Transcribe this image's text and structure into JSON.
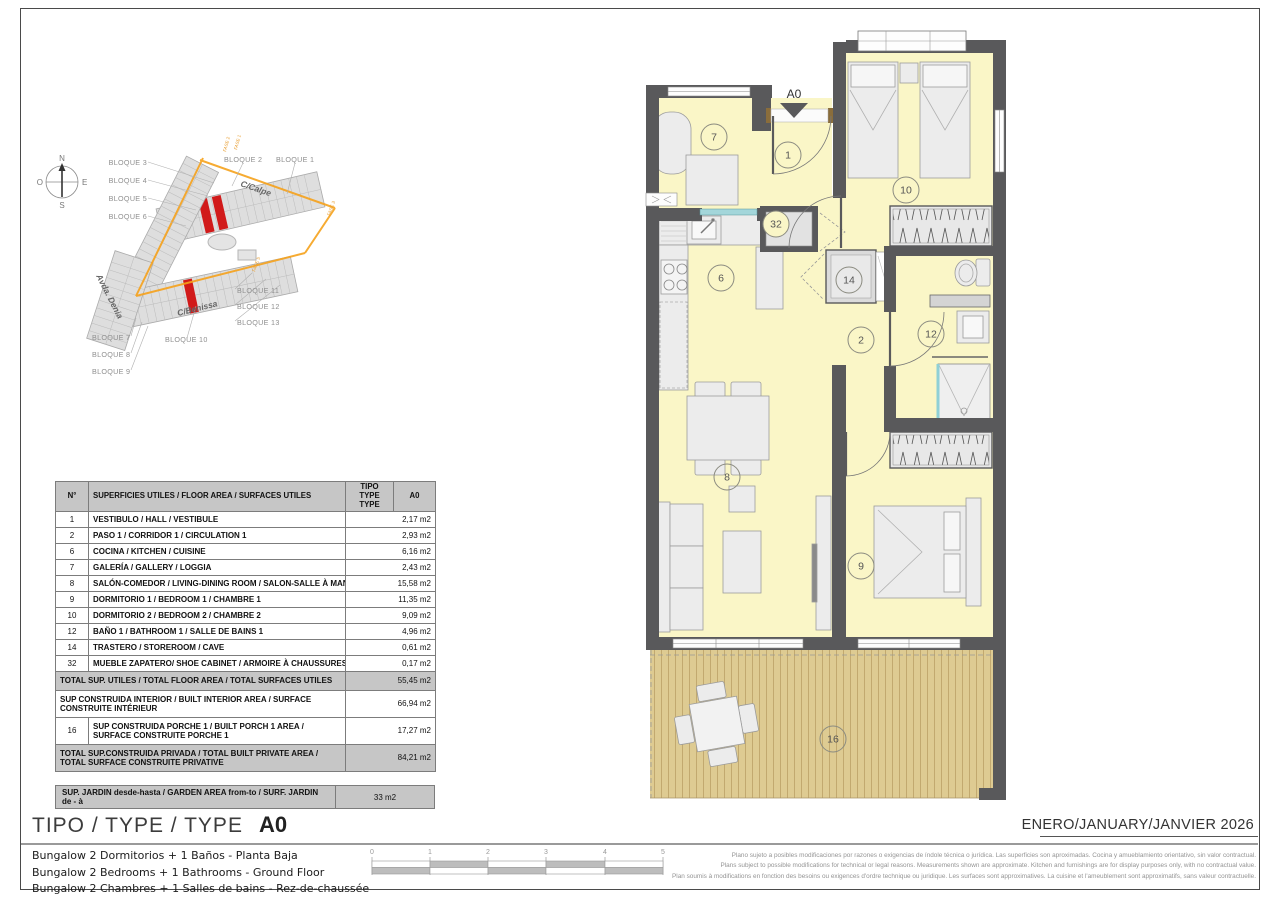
{
  "site_plan": {
    "compass": {
      "n": "N",
      "e": "E",
      "s": "S",
      "o": "O"
    },
    "labels": [
      {
        "text": "BLOQUE 3"
      },
      {
        "text": "BLOQUE 4"
      },
      {
        "text": "BLOQUE 5"
      },
      {
        "text": "BLOQUE 6"
      },
      {
        "text": "BLOQUE 2"
      },
      {
        "text": "BLOQUE 1"
      },
      {
        "text": "BLOQUE 11"
      },
      {
        "text": "BLOQUE 12"
      },
      {
        "text": "BLOQUE 13"
      },
      {
        "text": "BLOQUE 10"
      },
      {
        "text": "BLOQUE 7"
      },
      {
        "text": "BLOQUE 8"
      },
      {
        "text": "BLOQUE 9"
      }
    ],
    "streets": [
      {
        "text": "C/Calpe"
      },
      {
        "text": "C/Benissa"
      },
      {
        "text": "Avda. Denia"
      }
    ],
    "fase_labels": [
      {
        "text": "FASE 1"
      },
      {
        "text": "FASE 2"
      },
      {
        "text": "FASE 3"
      },
      {
        "text": "FASE 5"
      }
    ],
    "highlight_color": "#d11a1a",
    "road_color": "#f6a21c"
  },
  "area_table": {
    "header": {
      "num": "N°",
      "label": "SUPERFICIES UTILES / FLOOR AREA / SURFACES UTILES",
      "tipo": "TIPO TYPE TYPE",
      "a0": "A0"
    },
    "rows": [
      {
        "num": "1",
        "label": "VESTIBULO / HALL / VESTIBULE",
        "value": "2,17 m2"
      },
      {
        "num": "2",
        "label": "PASO 1 / CORRIDOR 1 / CIRCULATION 1",
        "value": "2,93 m2"
      },
      {
        "num": "6",
        "label": "COCINA / KITCHEN / CUISINE",
        "value": "6,16 m2"
      },
      {
        "num": "7",
        "label": "GALERÍA / GALLERY / LOGGIA",
        "value": "2,43 m2"
      },
      {
        "num": "8",
        "label": "SALÓN-COMEDOR / LIVING-DINING ROOM / SALON-SALLE À MANGER",
        "value": "15,58 m2"
      },
      {
        "num": "9",
        "label": "DORMITORIO 1 / BEDROOM 1 / CHAMBRE 1",
        "value": "11,35 m2"
      },
      {
        "num": "10",
        "label": "DORMITORIO 2 / BEDROOM 2 / CHAMBRE 2",
        "value": "9,09 m2"
      },
      {
        "num": "12",
        "label": "BAÑO 1 / BATHROOM 1 / SALLE DE BAINS 1",
        "value": "4,96 m2"
      },
      {
        "num": "14",
        "label": "TRASTERO / STOREROOM / CAVE",
        "value": "0,61 m2"
      },
      {
        "num": "32",
        "label": "MUEBLE ZAPATERO/ SHOE CABINET / ARMOIRE À CHAUSSURES",
        "value": "0,17 m2"
      }
    ],
    "total_utiles": {
      "label": "TOTAL SUP. UTILES / TOTAL FLOOR AREA / TOTAL SURFACES UTILES",
      "value": "55,45 m2"
    },
    "built_interior": {
      "label": "SUP CONSTRUIDA INTERIOR / BUILT INTERIOR AREA / SURFACE CONSTRUITE INTÉRIEUR",
      "value": "66,94 m2"
    },
    "porch": {
      "num": "16",
      "label": "SUP CONSTRUIDA PORCHE 1 / BUILT PORCH 1 AREA / SURFACE CONSTRUITE PORCHE 1",
      "value": "17,27 m2"
    },
    "total_private": {
      "label": "TOTAL SUP.CONSTRUIDA PRIVADA / TOTAL BUILT PRIVATE AREA / TOTAL SURFACE CONSTRUITE PRIVATIVE",
      "value": "84,21 m2"
    },
    "garden": {
      "label": "SUP. JARDIN desde-hasta / GARDEN AREA from-to / SURF. JARDIN de - à",
      "value": "33 m2"
    }
  },
  "floor_plan": {
    "entry_label": "A0",
    "room_fill": "#faf6c7",
    "wall_color": "#59595b",
    "terrace_fill": "#decb92",
    "rooms": [
      {
        "id": "7"
      },
      {
        "id": "1"
      },
      {
        "id": "10"
      },
      {
        "id": "32"
      },
      {
        "id": "6"
      },
      {
        "id": "14"
      },
      {
        "id": "2"
      },
      {
        "id": "12"
      },
      {
        "id": "8"
      },
      {
        "id": "9"
      },
      {
        "id": "16"
      }
    ]
  },
  "title_block": {
    "title_label": "TIPO / TYPE / TYPE",
    "title_value": "A0",
    "date": "ENERO/JANUARY/JANVIER 2026",
    "descriptions": [
      "Bungalow 2 Dormitorios + 1 Baños - Planta Baja",
      "Bungalow 2 Bedrooms + 1 Bathrooms - Ground Floor",
      "Bungalow 2 Chambres + 1 Salles de bains - Rez-de-chaussée"
    ],
    "scale_ticks": [
      "0",
      "1",
      "2",
      "3",
      "4",
      "5"
    ],
    "disclaimer": [
      "Plano sujeto a posibles modificaciones por razones o exigencias de índole técnica o jurídica. Las superficies son aproximadas. Cocina y amueblamiento orientativo, sin valor contractual.",
      "Plans subject to possible modifications for technical or legal reasons. Measurements shown are approximate. Kitchen and furnishings are for display purposes only, with no contractual value.",
      "Plan soumis à modifications en fonction des besoins ou exigences d'ordre technique ou juridique. Les surfaces sont approximatives. La cuisine et l'ameublement sont approximatifs, sans valeur contractuelle."
    ]
  }
}
